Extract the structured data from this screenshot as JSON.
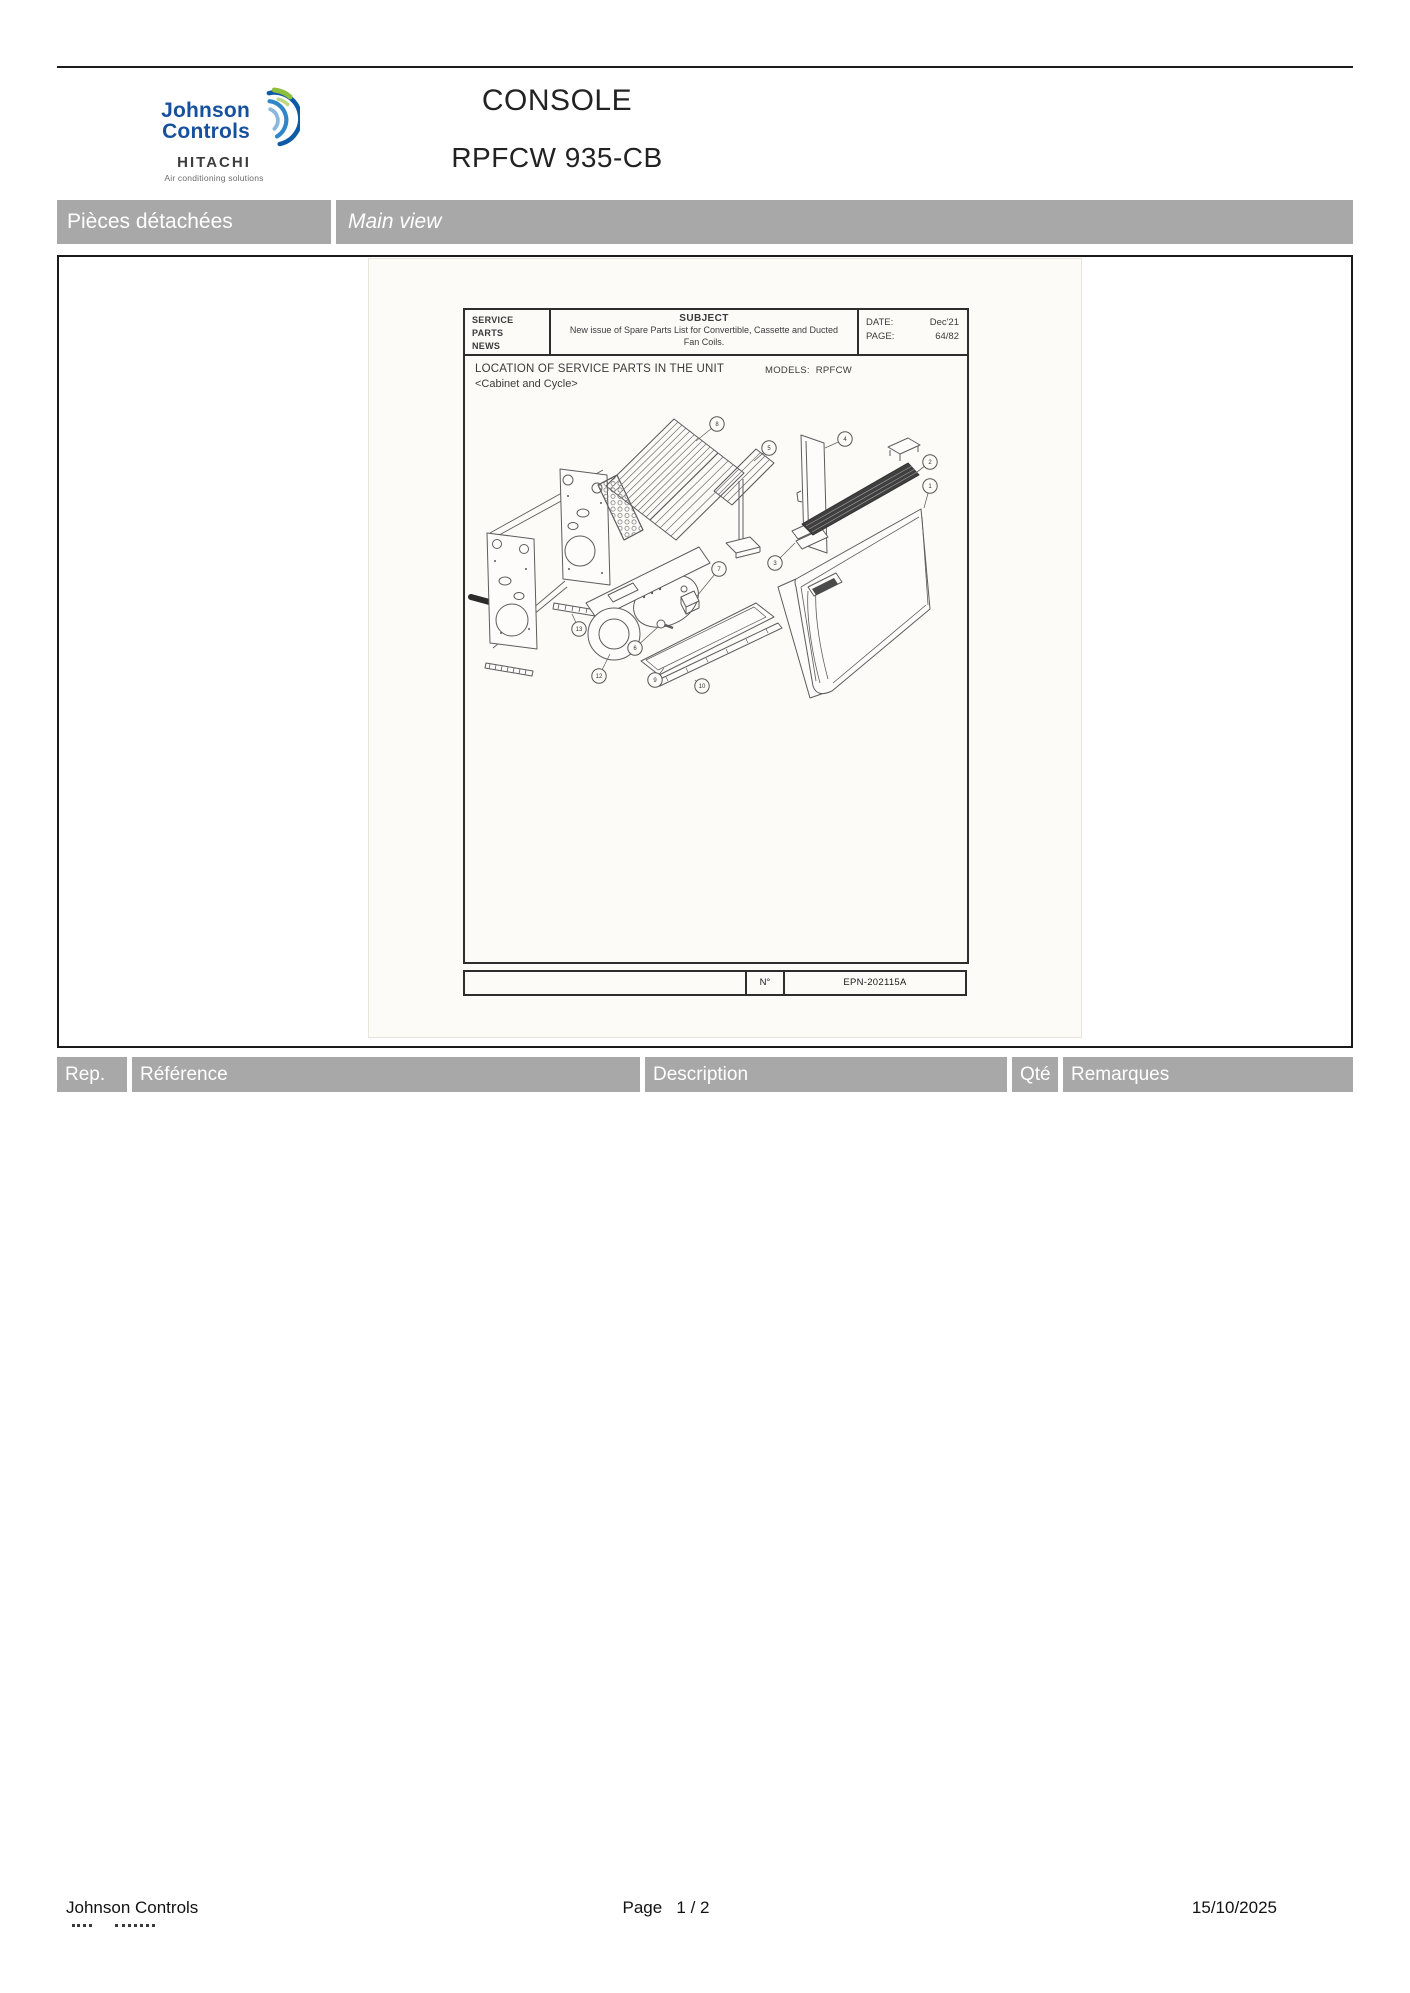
{
  "header": {
    "logo": {
      "brand_line1": "Johnson",
      "brand_line2": "Controls",
      "sub_brand": "HITACHI",
      "tagline": "Air conditioning solutions"
    },
    "title": "CONSOLE",
    "model": "RPFCW 935-CB"
  },
  "section_bar": {
    "left_label": "Pièces détachées",
    "right_label": "Main view"
  },
  "embedded_document": {
    "masthead": {
      "left_lines": [
        "SERVICE",
        "PARTS",
        "NEWS"
      ],
      "subject_label": "SUBJECT",
      "subject_text": "New issue of Spare Parts List for Convertible, Cassette and Ducted Fan Coils.",
      "date_label": "DATE:",
      "date_value": "Dec'21",
      "page_label": "PAGE:",
      "page_value": "64/82"
    },
    "body": {
      "location_title": "LOCATION OF SERVICE PARTS IN THE UNIT",
      "location_subtitle": "<Cabinet and Cycle>",
      "models_label": "MODELS:",
      "models_value": "RPFCW"
    },
    "doc_footer": {
      "number_label": "N°",
      "number_value": "EPN-202115A"
    },
    "callouts": [
      {
        "n": "8",
        "cx": 261,
        "cy": 33,
        "tx": 240,
        "ty": 50
      },
      {
        "n": "5",
        "cx": 313,
        "cy": 57,
        "tx": 298,
        "ty": 70
      },
      {
        "n": "4",
        "cx": 389,
        "cy": 48,
        "tx": 369,
        "ty": 57
      },
      {
        "n": "2",
        "cx": 474,
        "cy": 71,
        "tx": 461,
        "ty": 81
      },
      {
        "n": "1",
        "cx": 474,
        "cy": 95,
        "tx": 468,
        "ty": 117
      },
      {
        "n": "3",
        "cx": 319,
        "cy": 172,
        "tx": 339,
        "ty": 152
      },
      {
        "n": "7",
        "cx": 263,
        "cy": 178,
        "tx": 241,
        "ty": 205
      },
      {
        "n": "6",
        "cx": 179,
        "cy": 257,
        "tx": 202,
        "ty": 236
      },
      {
        "n": "13",
        "cx": 123,
        "cy": 238,
        "tx": 116,
        "ty": 223
      },
      {
        "n": "12",
        "cx": 143,
        "cy": 285,
        "tx": 154,
        "ty": 263
      },
      {
        "n": "9",
        "cx": 199,
        "cy": 289,
        "tx": 208,
        "ty": 277
      },
      {
        "n": "10",
        "cx": 246,
        "cy": 295,
        "tx": 239,
        "ty": 289
      }
    ]
  },
  "parts_table": {
    "columns": [
      "Rep.",
      "Référence",
      "Description",
      "Qté",
      "Remarques"
    ]
  },
  "page_footer": {
    "company": "Johnson Controls",
    "page_label": "Page",
    "page_value": "1  /  2",
    "date": "15/10/2025"
  }
}
